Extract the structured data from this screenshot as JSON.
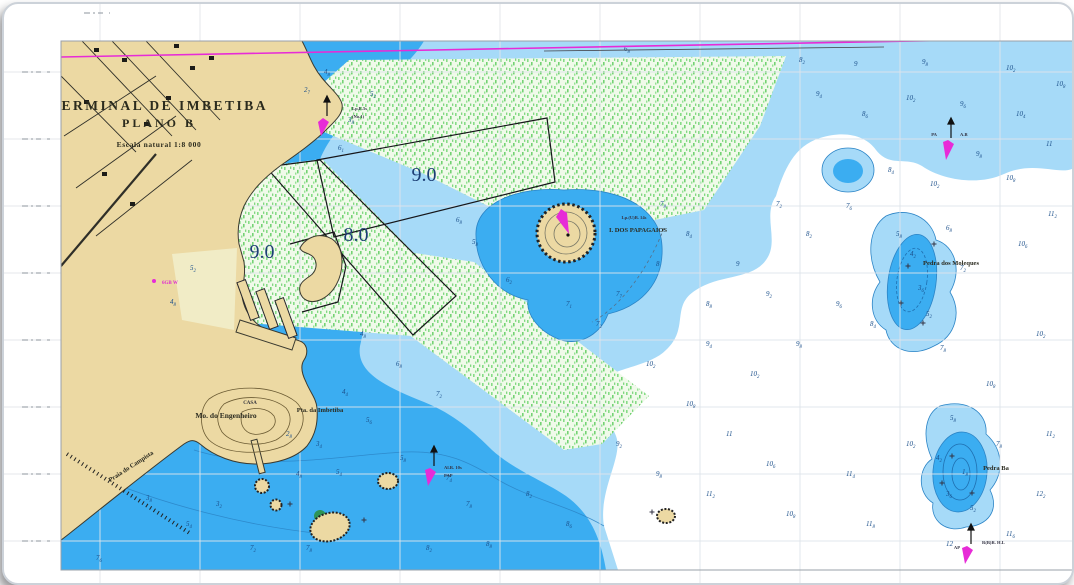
{
  "chart": {
    "title": {
      "line1": "TERMINAL DE IMBETIBA",
      "line2": "PLANO B",
      "scale": "Escala natural 1:8 000"
    },
    "depth_areas": [
      {
        "value": "9.0",
        "note": "dredged area north"
      },
      {
        "value": "8.0",
        "note": "dredged channel"
      },
      {
        "value": "9.0",
        "note": "harbour basin"
      }
    ],
    "places": {
      "engenheiro": "Mo. do Engenheiro",
      "casa": "CASA",
      "pta": "Pta. da Imbetiba",
      "praia": "Praia do Campista",
      "papagaios": "I. DOS PAPAGAIOS",
      "moleques": "Pedra dos Moleques",
      "pedra": "Pedra Ba"
    },
    "navaids": {
      "no1": {
        "line1": "Lp.E.5s",
        "line2": "(No.1)"
      },
      "pa": {
        "left": "PA",
        "right": "A.B"
      },
      "pap": {
        "line1": "Al.R. 10s",
        "line2": "PAP"
      },
      "ap": {
        "left": "AP",
        "right": "R(B)R. H.L"
      },
      "harbor_light": "6GB W",
      "papagaios_light": "Lp.(U)B. 14s"
    },
    "colors": {
      "land": "#ecd9a3",
      "sand_light": "#f1ecc6",
      "blue_medium": "#3badf1",
      "blue_light": "#a6daf8",
      "blue_core": "#2196dd",
      "deep_white": "#ffffff",
      "green_survey": "#7fd67f",
      "magenta": "#e72bd7",
      "depth_label": "#1c3e74",
      "sounding": "#1b4f8a"
    },
    "grid": {
      "v0": 96,
      "vstep": 100,
      "h0": 68,
      "hstep": 67,
      "left_tick_ys": [
        68,
        135,
        202,
        269,
        336,
        403,
        470,
        537
      ],
      "top_tick_xs": [
        93
      ],
      "right_tick_ys": [
        178,
        402,
        465,
        533
      ]
    },
    "soundings": [
      [
        320,
        70,
        "4",
        "8"
      ],
      [
        366,
        92,
        "5",
        "2"
      ],
      [
        300,
        88,
        "2",
        "7"
      ],
      [
        344,
        118,
        "3",
        "8"
      ],
      [
        334,
        146,
        "6",
        "1"
      ],
      [
        620,
        47,
        "6",
        "8"
      ],
      [
        795,
        58,
        "8",
        "2"
      ],
      [
        850,
        62,
        "9",
        ""
      ],
      [
        918,
        60,
        "9",
        "8"
      ],
      [
        1002,
        66,
        "10",
        "2"
      ],
      [
        1052,
        82,
        "10",
        "8"
      ],
      [
        812,
        92,
        "9",
        "4"
      ],
      [
        858,
        112,
        "8",
        "6"
      ],
      [
        902,
        96,
        "10",
        "2"
      ],
      [
        956,
        102,
        "9",
        "6"
      ],
      [
        1012,
        112,
        "10",
        "4"
      ],
      [
        1042,
        142,
        "11",
        ""
      ],
      [
        972,
        152,
        "9",
        "8"
      ],
      [
        884,
        168,
        "8",
        "4"
      ],
      [
        926,
        182,
        "10",
        "2"
      ],
      [
        1002,
        176,
        "10",
        "8"
      ],
      [
        1044,
        212,
        "11",
        "2"
      ],
      [
        1014,
        242,
        "10",
        "6"
      ],
      [
        842,
        204,
        "7",
        "6"
      ],
      [
        802,
        232,
        "8",
        "2"
      ],
      [
        772,
        202,
        "7",
        "2"
      ],
      [
        452,
        218,
        "6",
        "8"
      ],
      [
        468,
        240,
        "5",
        "8"
      ],
      [
        502,
        278,
        "6",
        "2"
      ],
      [
        562,
        302,
        "7",
        "1"
      ],
      [
        612,
        292,
        "7",
        "7"
      ],
      [
        652,
        262,
        "8",
        ""
      ],
      [
        682,
        232,
        "8",
        "4"
      ],
      [
        656,
        202,
        "7",
        "8"
      ],
      [
        592,
        322,
        "7",
        "2"
      ],
      [
        702,
        302,
        "8",
        "8"
      ],
      [
        732,
        262,
        "9",
        ""
      ],
      [
        762,
        292,
        "9",
        "2"
      ],
      [
        702,
        342,
        "9",
        "4"
      ],
      [
        746,
        372,
        "10",
        "2"
      ],
      [
        792,
        342,
        "9",
        "8"
      ],
      [
        832,
        302,
        "9",
        "6"
      ],
      [
        906,
        252,
        "4",
        "2"
      ],
      [
        914,
        286,
        "3",
        "6"
      ],
      [
        922,
        312,
        "5",
        "2"
      ],
      [
        892,
        232,
        "5",
        "8"
      ],
      [
        942,
        226,
        "6",
        "8"
      ],
      [
        956,
        266,
        "7",
        "2"
      ],
      [
        936,
        346,
        "7",
        "8"
      ],
      [
        866,
        322,
        "8",
        "4"
      ],
      [
        642,
        362,
        "10",
        "2"
      ],
      [
        682,
        402,
        "10",
        "8"
      ],
      [
        722,
        432,
        "11",
        ""
      ],
      [
        762,
        462,
        "10",
        "6"
      ],
      [
        652,
        472,
        "9",
        "8"
      ],
      [
        612,
        442,
        "9",
        "2"
      ],
      [
        702,
        492,
        "11",
        "2"
      ],
      [
        782,
        512,
        "10",
        "8"
      ],
      [
        842,
        472,
        "11",
        "4"
      ],
      [
        902,
        442,
        "10",
        "2"
      ],
      [
        862,
        522,
        "11",
        "8"
      ],
      [
        942,
        542,
        "12",
        ""
      ],
      [
        1002,
        532,
        "11",
        "6"
      ],
      [
        1032,
        492,
        "12",
        "2"
      ],
      [
        1042,
        432,
        "11",
        "2"
      ],
      [
        982,
        382,
        "10",
        "8"
      ],
      [
        1032,
        332,
        "10",
        "2"
      ],
      [
        946,
        416,
        "5",
        "8"
      ],
      [
        932,
        456,
        "4",
        "2"
      ],
      [
        958,
        470,
        "1",
        "8"
      ],
      [
        942,
        492,
        "3",
        "6"
      ],
      [
        966,
        506,
        "5",
        "2"
      ],
      [
        992,
        442,
        "7",
        "8"
      ],
      [
        212,
        502,
        "3",
        "2"
      ],
      [
        292,
        472,
        "4",
        "8"
      ],
      [
        332,
        470,
        "5",
        "4"
      ],
      [
        396,
        456,
        "5",
        "8"
      ],
      [
        442,
        476,
        "7",
        "4"
      ],
      [
        462,
        502,
        "7",
        "8"
      ],
      [
        522,
        492,
        "8",
        "2"
      ],
      [
        562,
        522,
        "8",
        "6"
      ],
      [
        482,
        542,
        "8",
        "8"
      ],
      [
        422,
        546,
        "8",
        "2"
      ],
      [
        302,
        546,
        "7",
        "8"
      ],
      [
        246,
        546,
        "7",
        "2"
      ],
      [
        182,
        522,
        "5",
        "4"
      ],
      [
        142,
        496,
        "3",
        "8"
      ],
      [
        92,
        556,
        "7",
        "6"
      ],
      [
        186,
        266,
        "5",
        "2"
      ],
      [
        166,
        300,
        "4",
        "8"
      ],
      [
        356,
        332,
        "4",
        "8"
      ],
      [
        392,
        362,
        "6",
        "8"
      ],
      [
        432,
        392,
        "7",
        "2"
      ],
      [
        282,
        432,
        "2",
        "8"
      ],
      [
        312,
        442,
        "3",
        "4"
      ],
      [
        362,
        418,
        "5",
        "6"
      ],
      [
        338,
        390,
        "4",
        "4"
      ]
    ],
    "rocks": [
      [
        904,
        262
      ],
      [
        897,
        299
      ],
      [
        919,
        319
      ],
      [
        930,
        240
      ],
      [
        948,
        452
      ],
      [
        968,
        489
      ],
      [
        938,
        479
      ],
      [
        286,
        500
      ],
      [
        360,
        516
      ],
      [
        648,
        508
      ]
    ]
  }
}
